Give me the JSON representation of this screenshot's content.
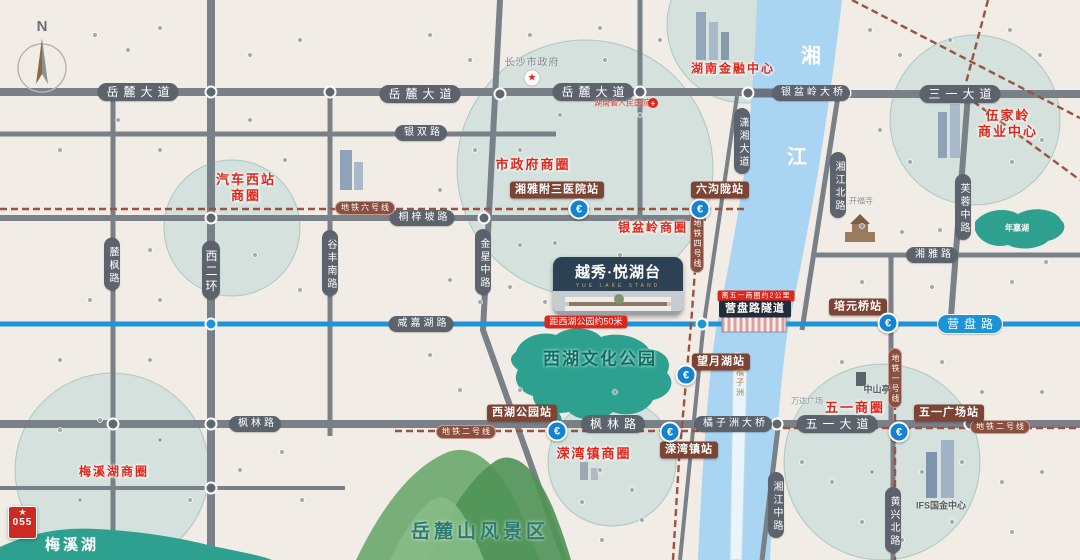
{
  "compass": {
    "label": "N"
  },
  "logo": {
    "badge": "055"
  },
  "icons": {
    "metro_glyph": "€",
    "star_glyph": "★",
    "cross_glyph": "+"
  },
  "property": {
    "brand_cn": "越秀·悦湖台",
    "brand_en": "YUE LAKE STAND",
    "distance_badge": "距西湖公园约50米"
  },
  "tunnel": {
    "name": "营盘路隧道",
    "note": "离五一商圈约2公里"
  },
  "roads": {
    "yuelu": "岳麓大道",
    "yinshuang": "银双路",
    "tongzipo": "桐梓坡路",
    "xianjiahu": "咸嘉湖路",
    "yinpenling_bridge": "银盆岭大桥",
    "sanyi": "三一大道",
    "xiangya_rd": "湘雅路",
    "yingpan": "营盘路",
    "fenglin": "枫林路",
    "juzizhou_bridge": "橘子洲大桥",
    "wuyi_ave": "五一大道",
    "lufeng": "麓枫路",
    "xierhuan": "西二环",
    "gufeng": "谷丰南路",
    "jinxing": "金星中路",
    "xiaoxiang": "潇湘大道",
    "xiangjiang_north": "湘江北路",
    "furong": "芙蓉中路",
    "xiangjiang_middle": "湘江中路",
    "huangxing_north": "黄兴北路"
  },
  "metro": {
    "line1": "地铁一号线",
    "line2": "地铁二号线",
    "line4": "地铁四号线",
    "line6": "地铁六号线"
  },
  "stations": {
    "xiangya_hospital": "湘雅附三医院站",
    "liugoulong": "六沟陇站",
    "peiyuanqiao": "培元桥站",
    "wangyuehu": "望月湖站",
    "xihu_park": "西湖公园站",
    "rongwanzhen": "溁湾镇站",
    "wuyi_square": "五一广场站"
  },
  "business_circles": {
    "qichexizhan_line1": "汽车西站",
    "qichexizhan_line2": "商圈",
    "shizhengfu": "市政府商圈",
    "yinpenling": "银盆岭商圈",
    "hunan_finance": "湖南金融中心",
    "wujialing_line1": "伍家岭",
    "wujialing_line2": "商业中心",
    "meixihu": "梅溪湖商圈",
    "rongwanzhen": "溁湾镇商圈",
    "wuyi": "五一商圈"
  },
  "landmarks": {
    "changsha_gov": "长沙市政府",
    "renmin_hospital": "湖南省人民医院",
    "kaifu_temple": "开福寺",
    "zhongshanting": "中山亭",
    "wanda": "万达广场",
    "ifs": "IFS国金中心"
  },
  "water": {
    "river_char_1": "湘",
    "river_char_2": "江",
    "island": "橘子洲",
    "xihu_culture_park": "西湖文化公园",
    "nianjia_lake": "年嘉湖",
    "meixi_lake": "梅溪湖"
  },
  "scenic": {
    "yuelushan": "岳麓山风景区"
  },
  "colors": {
    "road": "#767c84",
    "river": "#a9d4f2",
    "metro_line": "#9b5243",
    "highlight_blue": "#1d93d8",
    "station_badge": "#7c4434",
    "red": "#e0251b",
    "teal": "#2ea293",
    "card_navy": "#2d4154"
  }
}
